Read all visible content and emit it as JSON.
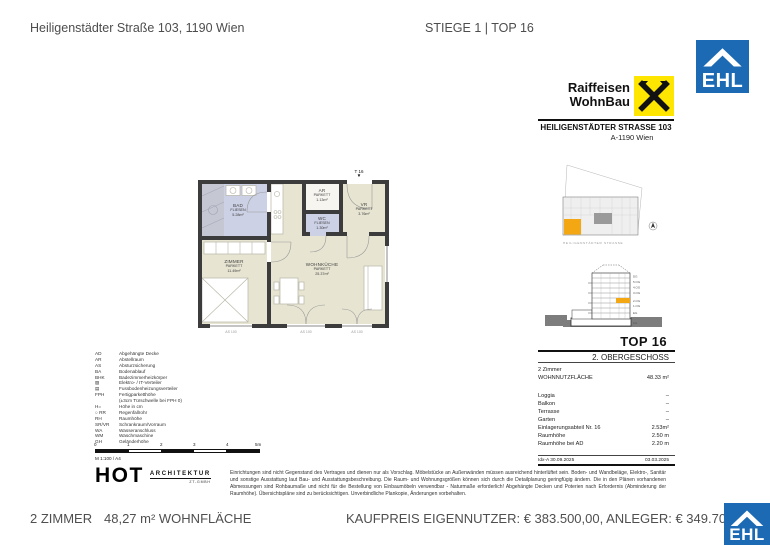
{
  "colors": {
    "ehl_blue": "#1B6AB3",
    "raiffeisen_yellow": "#FFE600",
    "highlight_orange": "#F3A712",
    "parkett_beige": "#E7E5D2",
    "fliesen_blue": "#CCD1E5",
    "wall_dark": "#3C3C3C"
  },
  "header": {
    "address": "Heiligenstädter Straße 103, 1190 Wien",
    "unit_ref": "STIEGE 1 | TOP 16"
  },
  "ehl": {
    "logo_text": "EHL"
  },
  "raiffeisen": {
    "name_line1": "Raiffeisen",
    "name_line2": "WohnBau",
    "address_line1": "HEILIGENSTÄDTER STRASSE 103",
    "address_line2": "A-1190 Wien"
  },
  "site_plan": {
    "street_label": "HEILIGENSTÄDTER STRASSE"
  },
  "section": {
    "floors": [
      "DG",
      "5.OG",
      "4.OG",
      "3.OG",
      "2.OG",
      "1.OG",
      "EG",
      "KG"
    ],
    "highlight_floor": "2.OG"
  },
  "unit_info": {
    "top": "TOP 16",
    "floor": "2. OBERGESCHOSS",
    "rooms": "2 Zimmer",
    "rows": [
      {
        "label": "WOHNNUTZFLÄCHE",
        "value": "48.33 m²"
      },
      {
        "label": "Loggia",
        "value": "–"
      },
      {
        "label": "Balkon",
        "value": "–"
      },
      {
        "label": "Terrasse",
        "value": "–"
      },
      {
        "label": "Garten",
        "value": "–"
      },
      {
        "label": "Einlagerungsabteil Nr. 16",
        "value": "2.53m²"
      },
      {
        "label": "Raumhöhe",
        "value": "2.50 m"
      },
      {
        "label": "Raumhöhe bei AD",
        "value": "2.20 m"
      }
    ],
    "index_note": "Idx-A 30.09.2025",
    "plan_date": "03.03.2025"
  },
  "floor_plan": {
    "entrance_label": "T 16",
    "entrance_marker": "▼",
    "rooms": {
      "bad": {
        "name": "BAD",
        "finish": "FLIESEN",
        "area": "5.28m²"
      },
      "zimmer": {
        "name": "ZIMMER",
        "finish": "PARKETT",
        "area": "11.49m²"
      },
      "ar": {
        "name": "AR",
        "finish": "PARKETT",
        "area": "1.13m²"
      },
      "wc": {
        "name": "WC",
        "finish": "FLIESEN",
        "area": "1.30m²"
      },
      "vr": {
        "name": "VR",
        "finish": "PARKETT",
        "area": "3.76m²"
      },
      "wohnkueche": {
        "name": "WOHNKÜCHE",
        "finish": "PARKETT",
        "area": "25.37m²"
      }
    },
    "dimension_labels": [
      "AS 100",
      "AS 100",
      "AS 100"
    ]
  },
  "legend": {
    "items": [
      {
        "abbr": "AD",
        "text": "Abgehängte Decke"
      },
      {
        "abbr": "AR",
        "text": "Abstellraum"
      },
      {
        "abbr": "AS",
        "text": "Absturzsicherung"
      },
      {
        "abbr": "BA",
        "text": "Bodenablauf"
      },
      {
        "abbr": "BHK",
        "text": "Badezimmerheizkörper"
      },
      {
        "abbr": "▨",
        "text": "Elektro- / IT-Verteiler"
      },
      {
        "abbr": "▤",
        "text": "Fussbodenheizungsverteiler"
      },
      {
        "abbr": "FPH",
        "text": "Fertigparketthöhe"
      },
      {
        "abbr": "",
        "text": "(±3cm Türschwelle bei FPH 0)"
      },
      {
        "abbr": "H=",
        "text": "Höhe in cm"
      },
      {
        "abbr": "○ RR",
        "text": "Regenfallrohr"
      },
      {
        "abbr": "RH",
        "text": "Raumhöhe"
      },
      {
        "abbr": "SR/VR",
        "text": "Schrankraum/Vorraum"
      },
      {
        "abbr": "WA",
        "text": "Wasseranschluss"
      },
      {
        "abbr": "WM",
        "text": "Waschmaschine"
      },
      {
        "abbr": "GH",
        "text": "Geländerhöhe"
      }
    ]
  },
  "scale_bar": {
    "ticks": [
      "0",
      "1",
      "2",
      "3",
      "4",
      "5m"
    ],
    "label": "M 1:100 / A4"
  },
  "architect": {
    "name": "HOT",
    "type": "ARCHITEKTUR",
    "suffix": "ZT-GMBH"
  },
  "disclaimer": "Einrichtungen sind nicht Gegenstand des Vertrages und dienen nur als Vorschlag. Möbelstücke an Außenwänden müssen ausreichend hinterlüftet sein. Boden- und Wandbeläge, Elektro-, Sanitär und sonstige Ausstattung laut Bau- und Ausstattungsbeschreibung. Die Raum- und Wohnungsgrößen können sich durch die Detailplanung geringfügig ändern. Die in den Plänen vorhandenen Abmessungen sind Rohbaumaße und nicht für die Bestellung von Einbaumöbeln verwendbar - Naturmaße erforderlich! Abgehängte Decken und Poterien nach Erfordernis (Abminderung der Raumhöhe). Übersichtspläne sind zu berücksichtigen. Unverbindliche Plankopie, Änderungen vorbehalten.",
  "footer": {
    "rooms": "2 ZIMMER",
    "area": "48,27 m² WOHNFLÄCHE",
    "price": "KAUFPREIS EIGENNUTZER: € 383.500,00, ANLEGER: € 349.700,"
  }
}
